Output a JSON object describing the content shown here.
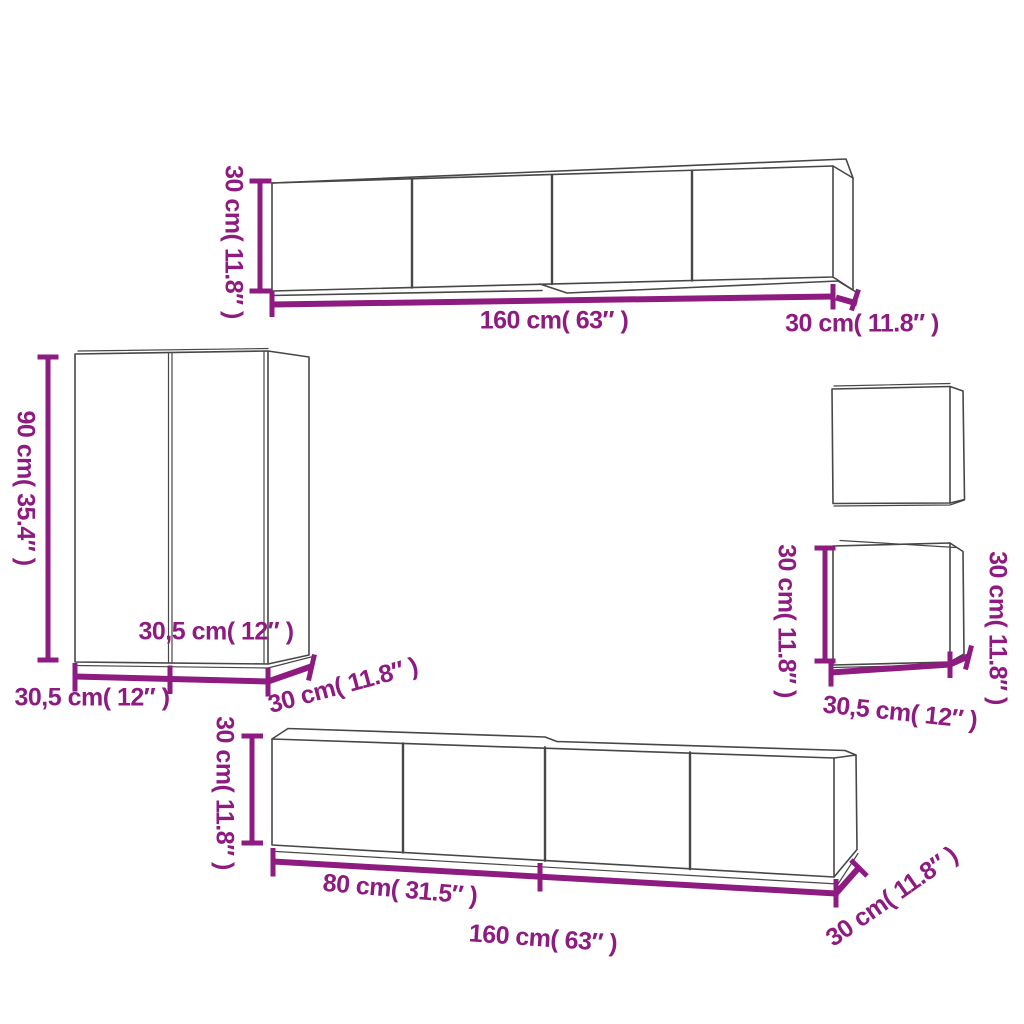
{
  "diagram": {
    "background": "#ffffff",
    "dimension_color": "#8D1B80",
    "outline_color": "#474747",
    "cabinets": {
      "top_tv_unit": {
        "height_label": "30 cm( 11.8″ )",
        "width_label": "160 cm( 63″ )",
        "depth_label": "30 cm( 11.8″ )"
      },
      "tall_side_cabinet": {
        "height_label": "90 cm( 35.4″ )",
        "door_width_label": "30,5 cm( 12″ )",
        "width_label": "30,5 cm( 12″ )",
        "depth_label": "30 cm( 11.8″ )"
      },
      "small_wall_cabinet": {
        "height_label_left": "30 cm( 11.8″ )",
        "height_label_right": "30 cm( 11.8″ )",
        "width_label": "30,5 cm( 12″ )"
      },
      "bottom_tv_bench": {
        "height_label": "30 cm( 11.8″ )",
        "half_width_label": "80 cm( 31.5″ )",
        "width_label": "160 cm( 63″ )",
        "depth_label": "30 cm( 11.8″ )"
      }
    }
  }
}
